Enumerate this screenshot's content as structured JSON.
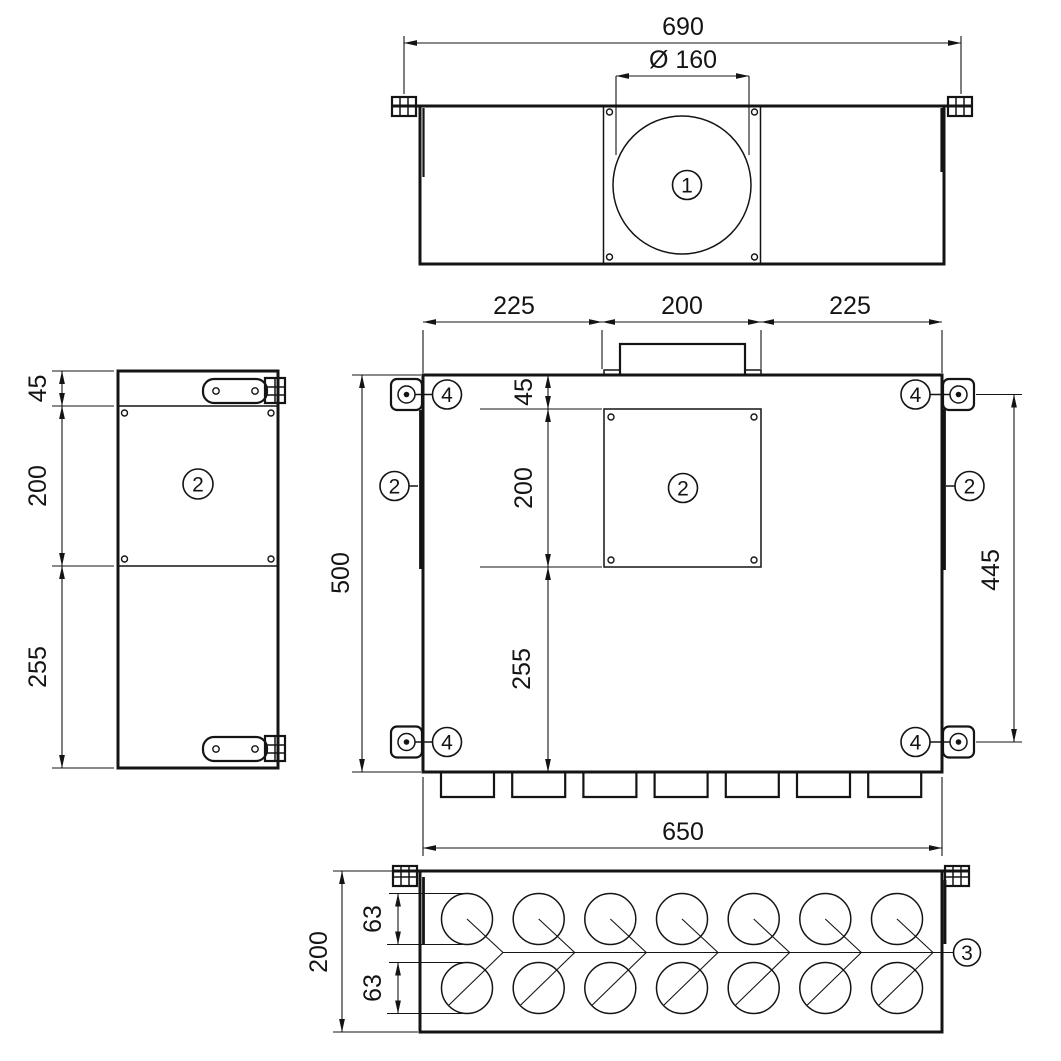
{
  "drawing_title": "Plenum box dimension drawing",
  "line_color": "#141414",
  "background": "#ffffff",
  "callouts": {
    "item1": "1",
    "item2": "2",
    "item3": "3",
    "item4": "4"
  },
  "top_view": {
    "dim_width": "690",
    "dim_diameter": "Ø 160"
  },
  "front_view": {
    "dim_top_left": "225",
    "dim_top_center": "200",
    "dim_top_right": "225",
    "dim_45": "45",
    "dim_200": "200",
    "dim_255": "255",
    "dim_overall_height": "500",
    "dim_bracket_span": "445",
    "dim_bottom_width": "650"
  },
  "side_view": {
    "dim_45": "45",
    "dim_200": "200",
    "dim_255": "255"
  },
  "bottom_view": {
    "dim_depth": "200",
    "dim_hole_row_top": "63",
    "dim_hole_row_bottom": "63"
  }
}
